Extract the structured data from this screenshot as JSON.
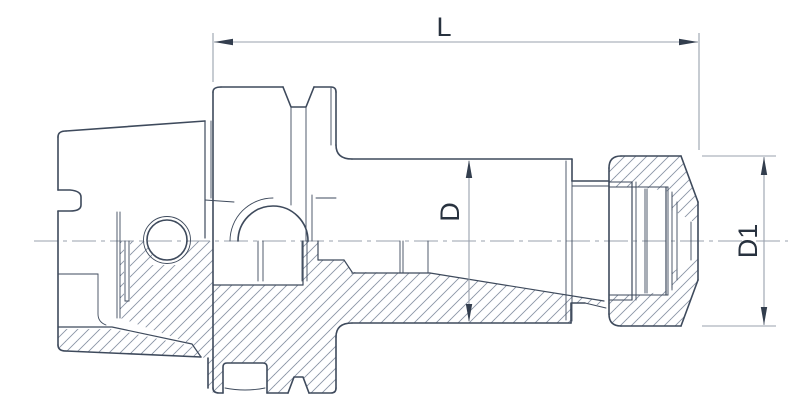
{
  "drawing": {
    "title": "Collet chuck technical drawing (half-section)",
    "labels": {
      "overall_length": "L",
      "body_diameter": "D",
      "nut_diameter": "D1"
    }
  },
  "colors": {
    "line": "#3e4a5c",
    "hatch": "#8a94a4",
    "dim": "#99a1ad",
    "arrow": "#333e4e",
    "text": "#28323f",
    "bg": "#ffffff"
  }
}
